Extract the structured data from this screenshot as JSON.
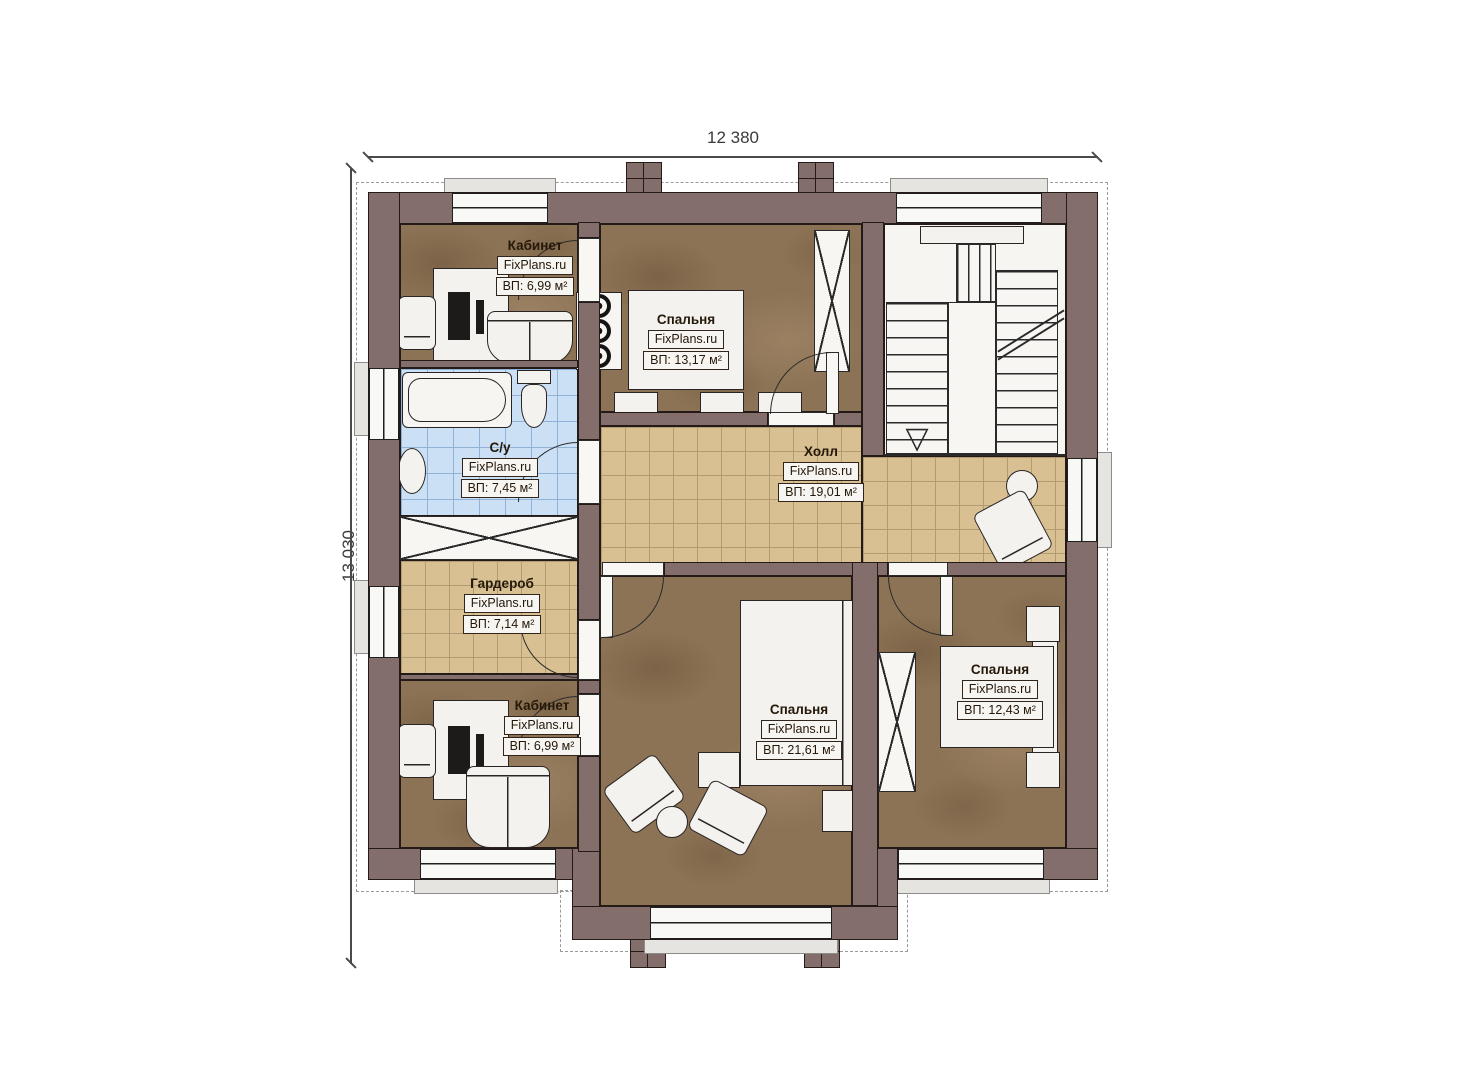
{
  "plan": {
    "type": "second-floor plan",
    "brand": "FixPlans.ru"
  },
  "dimensions": {
    "width": "12 380",
    "height": "13 030"
  },
  "rooms": {
    "office_top": {
      "name": "Кабинет",
      "brand": "FixPlans.ru",
      "area": "ВП: 6,99 м²"
    },
    "bedroom_top": {
      "name": "Спальня",
      "brand": "FixPlans.ru",
      "area": "ВП: 13,17 м²"
    },
    "bathroom": {
      "name": "С/у",
      "brand": "FixPlans.ru",
      "area": "ВП: 7,45 м²"
    },
    "hall": {
      "name": "Холл",
      "brand": "FixPlans.ru",
      "area": "ВП: 19,01 м²"
    },
    "wardrobe": {
      "name": "Гардероб",
      "brand": "FixPlans.ru",
      "area": "ВП: 7,14 м²"
    },
    "office_bottom": {
      "name": "Кабинет",
      "brand": "FixPlans.ru",
      "area": "ВП: 6,99 м²"
    },
    "bedroom_center": {
      "name": "Спальня",
      "brand": "FixPlans.ru",
      "area": "ВП: 21,61 м²"
    },
    "bedroom_right": {
      "name": "Спальня",
      "brand": "FixPlans.ru",
      "area": "ВП: 12,43 м²"
    }
  },
  "colors": {
    "wall": "#846e6c",
    "floor_brown": "#8d7355",
    "floor_tile_beige": "#d8c092",
    "tile_line_beige": "#b29a71",
    "floor_tile_blue": "#cce0f5",
    "tile_line_blue": "#8fb2d6",
    "furniture": "#f4f2ef",
    "label_box_bg": "#f7f5f1",
    "label_border": "#31241a",
    "text": "#241809",
    "dim_text": "#3a3a3a"
  },
  "stairs": {
    "arrow_icon": "▽"
  }
}
